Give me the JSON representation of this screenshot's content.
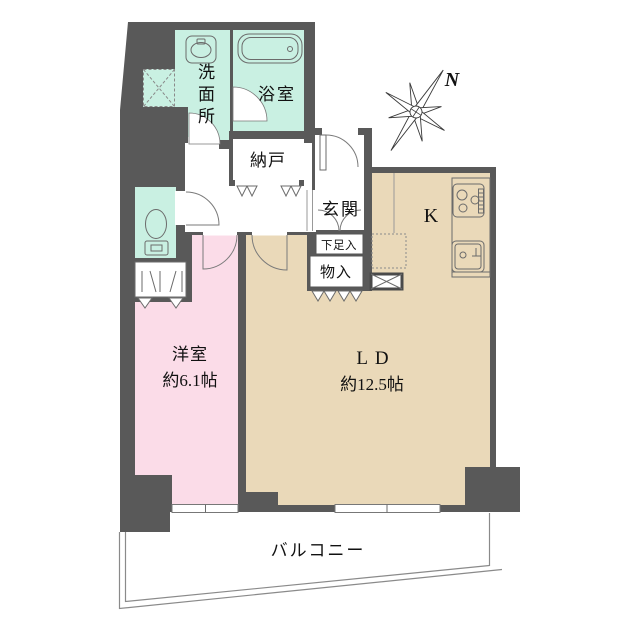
{
  "colors": {
    "wall": "#595959",
    "wet_room": "#c9f0e2",
    "bedroom": "#fbdce8",
    "living": "#ead9b9",
    "floor_white": "#ffffff"
  },
  "rooms": {
    "washroom": {
      "label": "洗面所",
      "chars": [
        "洗",
        "面",
        "所"
      ]
    },
    "bathroom": {
      "label": "浴室"
    },
    "storage_room": {
      "label": "納戸"
    },
    "entrance": {
      "label": "玄関"
    },
    "shoe_box": {
      "label": "下足入"
    },
    "storage_closet": {
      "label": "物入"
    },
    "kitchen": {
      "label": "K"
    },
    "living_dining": {
      "label": "LD",
      "size": "約12.5帖"
    },
    "western_room": {
      "label": "洋室",
      "size": "約6.1帖"
    },
    "balcony": {
      "label": "バルコニー"
    }
  },
  "compass": {
    "north_label": "N"
  }
}
